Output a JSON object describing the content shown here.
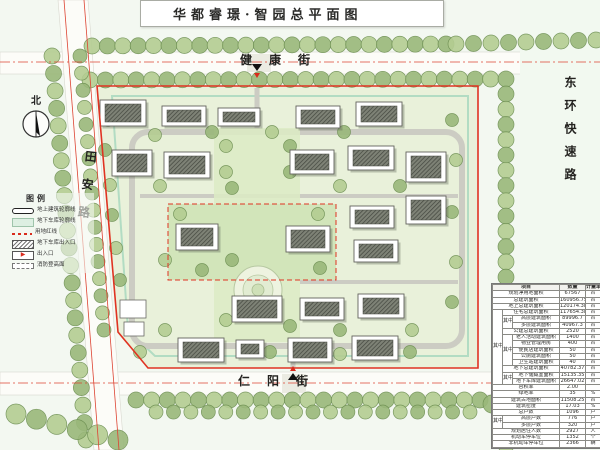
{
  "title": "华都睿璟·智园总平面图",
  "north_label": "北",
  "streets": {
    "top": "健康街",
    "bottom": "仁阳街",
    "left": "田安路",
    "right": "东环快速路"
  },
  "legend": {
    "header": "图例",
    "items": [
      {
        "icon": "building-outline",
        "label": "地上建筑轮廓线"
      },
      {
        "icon": "garage-outline",
        "label": "地下车库轮廓线"
      },
      {
        "icon": "red-line",
        "label": "用地红线"
      },
      {
        "icon": "garage-entrance",
        "label": "地下车库出入口"
      },
      {
        "icon": "entrance",
        "label": "出入口"
      },
      {
        "icon": "fire-access",
        "label": "消防登高面"
      }
    ]
  },
  "table": {
    "rows": [
      {
        "hd": true,
        "cells": [
          {
            "t": "项目",
            "cs": 3
          },
          {
            "t": "数量"
          },
          {
            "t": "计量单位"
          }
        ]
      },
      {
        "cells": [
          {
            "t": "规划净用地面积",
            "cs": 3
          },
          {
            "t": "67567"
          },
          {
            "t": "㎡"
          }
        ]
      },
      {
        "cells": [
          {
            "t": "总建筑面积",
            "cs": 3
          },
          {
            "t": "160956.75"
          },
          {
            "t": "㎡"
          }
        ]
      },
      {
        "cells": [
          {
            "t": "地上总建筑面积",
            "cs": 3
          },
          {
            "t": "120174.38"
          },
          {
            "t": "㎡"
          }
        ]
      },
      {
        "cells": [
          {
            "t": "其中",
            "rs": 12
          },
          {
            "t": "住宅总建筑面积",
            "cs": 2
          },
          {
            "t": "117654.38"
          },
          {
            "t": "㎡"
          }
        ]
      },
      {
        "cells": [
          {
            "t": "其中",
            "rs": 2
          },
          {
            "t": "高层建筑面积"
          },
          {
            "t": "89996.7"
          },
          {
            "t": "㎡"
          }
        ]
      },
      {
        "cells": [
          {
            "t": "多层建筑面积"
          },
          {
            "t": "40967.3"
          },
          {
            "t": "㎡"
          }
        ]
      },
      {
        "cells": [
          {
            "t": "公建总建筑面积",
            "cs": 2
          },
          {
            "t": "2520"
          },
          {
            "t": "㎡"
          }
        ]
      },
      {
        "cells": [
          {
            "t": "其中",
            "rs": 5
          },
          {
            "t": "老人活动建筑面积"
          },
          {
            "t": "1400"
          },
          {
            "t": "㎡"
          }
        ]
      },
      {
        "cells": [
          {
            "t": "物业管理用房"
          },
          {
            "t": "400"
          },
          {
            "t": "㎡"
          }
        ]
      },
      {
        "cells": [
          {
            "t": "便民店建筑面积"
          },
          {
            "t": "50"
          },
          {
            "t": "㎡"
          }
        ]
      },
      {
        "cells": [
          {
            "t": "公厕建筑面积"
          },
          {
            "t": "50"
          },
          {
            "t": "㎡"
          }
        ]
      },
      {
        "cells": [
          {
            "t": "卫生站建筑面积"
          },
          {
            "t": "40"
          },
          {
            "t": "㎡"
          }
        ]
      },
      {
        "cells": [
          {
            "t": "地下总建筑面积",
            "cs": 2
          },
          {
            "t": "40782.37"
          },
          {
            "t": "㎡"
          }
        ]
      },
      {
        "cells": [
          {
            "t": "其中",
            "rs": 2
          },
          {
            "t": "地下储藏室面积"
          },
          {
            "t": "15135.35"
          },
          {
            "t": "㎡"
          }
        ]
      },
      {
        "cells": [
          {
            "t": "地下车库建筑面积"
          },
          {
            "t": "26647.02"
          },
          {
            "t": "㎡"
          }
        ]
      },
      {
        "cells": [
          {
            "t": "容积率",
            "cs": 3
          },
          {
            "t": "2.00"
          },
          {
            "t": ""
          }
        ]
      },
      {
        "cells": [
          {
            "t": "绿地率",
            "cs": 3
          },
          {
            "t": "35"
          },
          {
            "t": "%"
          }
        ]
      },
      {
        "cells": [
          {
            "t": "建筑占地面积",
            "cs": 3
          },
          {
            "t": "11508.25"
          },
          {
            "t": "㎡"
          }
        ]
      },
      {
        "cells": [
          {
            "t": "建筑密度",
            "cs": 3
          },
          {
            "t": "17.03"
          },
          {
            "t": "%"
          }
        ]
      },
      {
        "cells": [
          {
            "t": "总户数",
            "cs": 3
          },
          {
            "t": "1096"
          },
          {
            "t": "户"
          }
        ]
      },
      {
        "cells": [
          {
            "t": "其中",
            "rs": 2
          },
          {
            "t": "高层户数",
            "cs": 2
          },
          {
            "t": "776"
          },
          {
            "t": "户"
          }
        ]
      },
      {
        "cells": [
          {
            "t": "多层户数",
            "cs": 2
          },
          {
            "t": "320"
          },
          {
            "t": "户"
          }
        ]
      },
      {
        "cells": [
          {
            "t": "规划居住人数",
            "cs": 3
          },
          {
            "t": "2927"
          },
          {
            "t": "人"
          }
        ]
      },
      {
        "cells": [
          {
            "t": "机动车停车位",
            "cs": 3
          },
          {
            "t": "1352"
          },
          {
            "t": "个"
          }
        ]
      },
      {
        "cells": [
          {
            "t": "非机动车停车位",
            "cs": 3
          },
          {
            "t": "2366"
          },
          {
            "t": "辆"
          }
        ]
      }
    ]
  },
  "map": {
    "buildings": [
      [
        100,
        100,
        46,
        26
      ],
      [
        162,
        106,
        44,
        20
      ],
      [
        218,
        108,
        42,
        18
      ],
      [
        296,
        106,
        44,
        22
      ],
      [
        356,
        102,
        46,
        24
      ],
      [
        112,
        150,
        40,
        26
      ],
      [
        164,
        152,
        46,
        26
      ],
      [
        290,
        150,
        44,
        24
      ],
      [
        348,
        146,
        46,
        24
      ],
      [
        406,
        152,
        40,
        30
      ],
      [
        176,
        224,
        42,
        26
      ],
      [
        286,
        226,
        44,
        26
      ],
      [
        350,
        206,
        44,
        22
      ],
      [
        354,
        240,
        44,
        22
      ],
      [
        406,
        196,
        40,
        28
      ],
      [
        232,
        296,
        50,
        26
      ],
      [
        300,
        298,
        44,
        22
      ],
      [
        358,
        294,
        46,
        24
      ],
      [
        178,
        338,
        46,
        24
      ],
      [
        288,
        338,
        44,
        24
      ],
      [
        352,
        336,
        46,
        24
      ],
      [
        236,
        340,
        28,
        18
      ]
    ],
    "entrances": [
      {
        "x": 257,
        "y": 64,
        "dir": "down"
      },
      {
        "x": 293,
        "y": 380,
        "dir": "up"
      }
    ]
  },
  "colors": {
    "red_line": "#e03322",
    "garage_line": "#b2dcc3",
    "site_green": "#e9f1da",
    "tree_green_1": "#9ab87a",
    "tree_green_2": "#b4cd92",
    "road_white": "#fcfcf8"
  }
}
